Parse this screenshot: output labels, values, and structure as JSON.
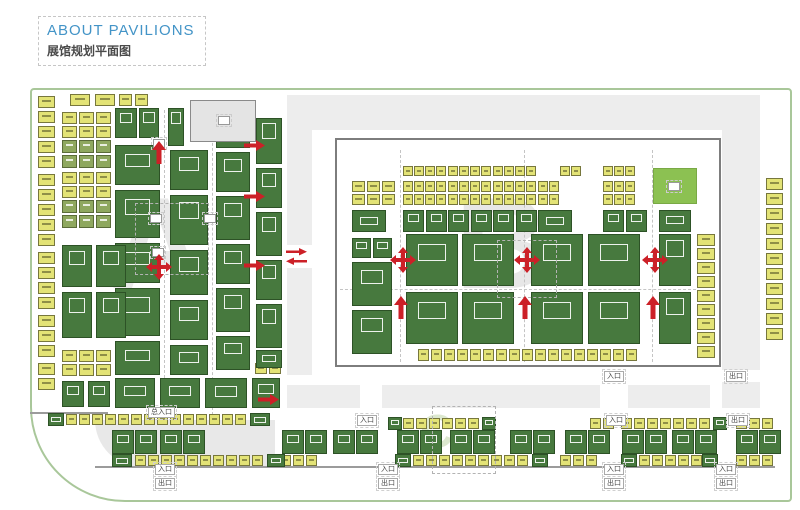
{
  "header": {
    "title_en": "ABOUT PAVILIONS",
    "title_zh": "展馆规划平面图"
  },
  "legend_colors": {
    "booth_yellow": "#e3e376",
    "booth_olive": "#8fa85f",
    "booth_green": "#47793e",
    "service_green": "#8cc152",
    "facility_gray": "#e4e4e4",
    "corridor_gray": "#ededed",
    "arrow_red": "#cc2027",
    "frame_green": "#a9c79a",
    "title_blue": "#4394c7"
  },
  "map": {
    "watermarks": [
      {
        "t": "A",
        "x": 110,
        "y": 178,
        "s": 130,
        "c": "#e9e9e9"
      },
      {
        "t": "B",
        "x": 455,
        "y": 178,
        "s": 130,
        "c": "#e7e7e7"
      },
      {
        "t": "C",
        "x": 420,
        "y": 408,
        "s": 46,
        "c": "#dce8cf"
      }
    ],
    "corridors": [
      [
        287,
        95,
        25,
        150
      ],
      [
        287,
        268,
        25,
        107
      ],
      [
        312,
        95,
        448,
        35
      ],
      [
        722,
        130,
        38,
        240
      ],
      [
        722,
        382,
        38,
        26
      ],
      [
        287,
        385,
        73,
        23
      ],
      [
        382,
        385,
        218,
        23
      ],
      [
        628,
        385,
        82,
        23
      ]
    ],
    "quarter": [
      95,
      420,
      180,
      47
    ],
    "wall": [
      335,
      138,
      386,
      229
    ],
    "roads": [
      [
        95,
        466,
        680
      ],
      [
        30,
        412,
        78
      ]
    ],
    "dashed_rects": [
      [
        135,
        203,
        72,
        70
      ],
      [
        497,
        240,
        58,
        56
      ],
      [
        432,
        406,
        62,
        66
      ]
    ],
    "vdash": [
      [
        164,
        110,
        418
      ],
      [
        212,
        108,
        415
      ],
      [
        400,
        150,
        362
      ],
      [
        524,
        150,
        362
      ],
      [
        652,
        150,
        362
      ]
    ],
    "hdash": [
      [
        340,
        289,
        356
      ]
    ],
    "markers": [
      [
        150,
        214
      ],
      [
        204,
        214
      ],
      [
        153,
        139
      ],
      [
        152,
        248
      ],
      [
        218,
        116
      ],
      [
        668,
        182
      ]
    ],
    "strips": [
      [
        38,
        96,
        5,
        0,
        15,
        17,
        12,
        "y"
      ],
      [
        38,
        174,
        5,
        0,
        15,
        17,
        12,
        "y"
      ],
      [
        38,
        252,
        4,
        0,
        15,
        17,
        12,
        "y"
      ],
      [
        38,
        315,
        3,
        0,
        15,
        17,
        12,
        "y"
      ],
      [
        38,
        363,
        2,
        0,
        15,
        17,
        12,
        "y"
      ],
      [
        70,
        94,
        2,
        25,
        0,
        20,
        12,
        "y"
      ],
      [
        119,
        94,
        2,
        16,
        0,
        13,
        12,
        "y"
      ],
      [
        62,
        112,
        3,
        17,
        0,
        15,
        12,
        "y"
      ],
      [
        62,
        126,
        3,
        17,
        0,
        15,
        12,
        "y"
      ],
      [
        62,
        140,
        3,
        17,
        0,
        15,
        13,
        "o"
      ],
      [
        62,
        155,
        3,
        17,
        0,
        15,
        13,
        "o"
      ],
      [
        62,
        172,
        3,
        17,
        0,
        15,
        12,
        "y"
      ],
      [
        62,
        186,
        3,
        17,
        0,
        15,
        12,
        "y"
      ],
      [
        62,
        200,
        3,
        17,
        0,
        15,
        13,
        "o"
      ],
      [
        62,
        215,
        3,
        17,
        0,
        15,
        13,
        "o"
      ],
      [
        62,
        350,
        3,
        17,
        0,
        15,
        12,
        "y"
      ],
      [
        62,
        364,
        3,
        17,
        0,
        15,
        12,
        "y"
      ],
      [
        255,
        363,
        2,
        14,
        0,
        12,
        11,
        "y"
      ],
      [
        403,
        166,
        4,
        11,
        0,
        10,
        10,
        "y"
      ],
      [
        448,
        166,
        4,
        11,
        0,
        10,
        10,
        "y"
      ],
      [
        493,
        166,
        4,
        11,
        0,
        10,
        10,
        "y"
      ],
      [
        560,
        166,
        2,
        11,
        0,
        10,
        10,
        "y"
      ],
      [
        603,
        166,
        3,
        11,
        0,
        10,
        10,
        "y"
      ],
      [
        352,
        181,
        3,
        15,
        0,
        13,
        11,
        "y"
      ],
      [
        403,
        181,
        4,
        11,
        0,
        10,
        11,
        "y"
      ],
      [
        448,
        181,
        4,
        11,
        0,
        10,
        11,
        "y"
      ],
      [
        493,
        181,
        4,
        11,
        0,
        10,
        11,
        "y"
      ],
      [
        538,
        181,
        2,
        11,
        0,
        10,
        11,
        "y"
      ],
      [
        603,
        181,
        3,
        11,
        0,
        10,
        11,
        "y"
      ],
      [
        352,
        194,
        3,
        15,
        0,
        13,
        11,
        "y"
      ],
      [
        403,
        194,
        4,
        11,
        0,
        10,
        11,
        "y"
      ],
      [
        448,
        194,
        4,
        11,
        0,
        10,
        11,
        "y"
      ],
      [
        493,
        194,
        4,
        11,
        0,
        10,
        11,
        "y"
      ],
      [
        538,
        194,
        2,
        11,
        0,
        10,
        11,
        "y"
      ],
      [
        603,
        194,
        3,
        11,
        0,
        10,
        11,
        "y"
      ],
      [
        418,
        349,
        17,
        13,
        0,
        11,
        12,
        "y"
      ],
      [
        697,
        234,
        9,
        0,
        14,
        18,
        12,
        "y"
      ],
      [
        766,
        178,
        11,
        0,
        15,
        17,
        12,
        "y"
      ],
      [
        66,
        414,
        14,
        13,
        0,
        11,
        11,
        "y"
      ],
      [
        403,
        418,
        6,
        13,
        0,
        11,
        11,
        "y"
      ],
      [
        590,
        418,
        2,
        13,
        0,
        11,
        11,
        "y"
      ],
      [
        621,
        418,
        7,
        13,
        0,
        11,
        11,
        "y"
      ],
      [
        736,
        418,
        3,
        13,
        0,
        11,
        11,
        "y"
      ],
      [
        135,
        455,
        10,
        13,
        0,
        11,
        11,
        "y"
      ],
      [
        280,
        455,
        3,
        13,
        0,
        11,
        11,
        "y"
      ],
      [
        413,
        455,
        9,
        13,
        0,
        11,
        11,
        "y"
      ],
      [
        560,
        455,
        3,
        13,
        0,
        11,
        11,
        "y"
      ],
      [
        639,
        455,
        5,
        13,
        0,
        11,
        11,
        "y"
      ],
      [
        736,
        455,
        3,
        13,
        0,
        11,
        11,
        "y"
      ],
      [
        112,
        430,
        2,
        23,
        0,
        22,
        24,
        "g"
      ],
      [
        160,
        430,
        2,
        23,
        0,
        22,
        24,
        "g"
      ],
      [
        282,
        430,
        2,
        23,
        0,
        22,
        24,
        "g"
      ],
      [
        333,
        430,
        2,
        23,
        0,
        22,
        24,
        "g"
      ],
      [
        397,
        430,
        2,
        23,
        0,
        22,
        24,
        "g"
      ],
      [
        450,
        430,
        2,
        23,
        0,
        22,
        24,
        "g"
      ],
      [
        510,
        430,
        2,
        23,
        0,
        22,
        24,
        "g"
      ],
      [
        565,
        430,
        2,
        23,
        0,
        22,
        24,
        "g"
      ],
      [
        622,
        430,
        2,
        23,
        0,
        22,
        24,
        "g"
      ],
      [
        672,
        430,
        2,
        23,
        0,
        22,
        24,
        "g"
      ],
      [
        736,
        430,
        2,
        23,
        0,
        22,
        24,
        "g"
      ]
    ],
    "blocks": [
      [
        115,
        108,
        22,
        30,
        "g"
      ],
      [
        139,
        108,
        20,
        30,
        "g"
      ],
      [
        168,
        108,
        16,
        38,
        "g"
      ],
      [
        115,
        145,
        45,
        40,
        "g"
      ],
      [
        115,
        190,
        45,
        48,
        "g"
      ],
      [
        115,
        243,
        45,
        40,
        "g"
      ],
      [
        115,
        288,
        45,
        48,
        "g"
      ],
      [
        115,
        341,
        45,
        34,
        "g"
      ],
      [
        170,
        150,
        38,
        40,
        "g"
      ],
      [
        170,
        195,
        38,
        50,
        "g"
      ],
      [
        170,
        250,
        38,
        45,
        "g"
      ],
      [
        170,
        300,
        38,
        40,
        "g"
      ],
      [
        170,
        345,
        38,
        30,
        "g"
      ],
      [
        216,
        112,
        34,
        36,
        "g"
      ],
      [
        216,
        152,
        34,
        40,
        "g"
      ],
      [
        216,
        196,
        34,
        44,
        "g"
      ],
      [
        216,
        244,
        34,
        40,
        "g"
      ],
      [
        216,
        288,
        34,
        44,
        "g"
      ],
      [
        216,
        336,
        34,
        34,
        "g"
      ],
      [
        256,
        118,
        26,
        46,
        "g"
      ],
      [
        256,
        168,
        26,
        40,
        "g"
      ],
      [
        256,
        212,
        26,
        44,
        "g"
      ],
      [
        256,
        260,
        26,
        40,
        "g"
      ],
      [
        256,
        304,
        26,
        44,
        "g"
      ],
      [
        256,
        350,
        26,
        18,
        "g"
      ],
      [
        62,
        245,
        30,
        42,
        "g"
      ],
      [
        96,
        245,
        30,
        42,
        "g"
      ],
      [
        62,
        292,
        30,
        46,
        "g"
      ],
      [
        96,
        292,
        30,
        46,
        "g"
      ],
      [
        62,
        381,
        22,
        26,
        "g"
      ],
      [
        88,
        381,
        22,
        26,
        "g"
      ],
      [
        115,
        378,
        40,
        30,
        "g"
      ],
      [
        160,
        378,
        40,
        30,
        "g"
      ],
      [
        205,
        378,
        42,
        30,
        "g"
      ],
      [
        252,
        378,
        28,
        30,
        "g"
      ],
      [
        352,
        238,
        19,
        20,
        "g"
      ],
      [
        373,
        238,
        19,
        20,
        "g"
      ],
      [
        352,
        262,
        40,
        44,
        "g"
      ],
      [
        352,
        310,
        40,
        44,
        "g"
      ],
      [
        406,
        234,
        52,
        52,
        "g"
      ],
      [
        462,
        234,
        52,
        52,
        "g"
      ],
      [
        406,
        292,
        52,
        52,
        "g"
      ],
      [
        462,
        292,
        52,
        52,
        "g"
      ],
      [
        531,
        234,
        52,
        52,
        "g"
      ],
      [
        588,
        234,
        52,
        52,
        "g"
      ],
      [
        531,
        292,
        52,
        52,
        "g"
      ],
      [
        588,
        292,
        52,
        52,
        "g"
      ],
      [
        659,
        234,
        32,
        52,
        "g"
      ],
      [
        659,
        292,
        32,
        52,
        "g"
      ],
      [
        659,
        210,
        32,
        22,
        "g"
      ],
      [
        352,
        210,
        34,
        22,
        "g"
      ],
      [
        403,
        210,
        21,
        22,
        "g"
      ],
      [
        426,
        210,
        21,
        22,
        "g"
      ],
      [
        448,
        210,
        21,
        22,
        "g"
      ],
      [
        471,
        210,
        21,
        22,
        "g"
      ],
      [
        493,
        210,
        21,
        22,
        "g"
      ],
      [
        516,
        210,
        21,
        22,
        "g"
      ],
      [
        538,
        210,
        34,
        22,
        "g"
      ],
      [
        603,
        210,
        21,
        22,
        "g"
      ],
      [
        626,
        210,
        21,
        22,
        "g"
      ],
      [
        653,
        168,
        44,
        36,
        "lg"
      ],
      [
        190,
        100,
        66,
        42,
        "gray"
      ],
      [
        48,
        413,
        16,
        13,
        "g"
      ],
      [
        250,
        413,
        20,
        13,
        "g"
      ],
      [
        388,
        417,
        14,
        13,
        "g"
      ],
      [
        482,
        417,
        14,
        13,
        "g"
      ],
      [
        713,
        417,
        14,
        13,
        "g"
      ],
      [
        112,
        454,
        20,
        13,
        "g"
      ],
      [
        267,
        454,
        18,
        13,
        "g"
      ],
      [
        395,
        454,
        16,
        13,
        "g"
      ],
      [
        532,
        454,
        16,
        13,
        "g"
      ],
      [
        621,
        454,
        16,
        13,
        "g"
      ],
      [
        702,
        454,
        16,
        13,
        "g"
      ]
    ],
    "arrows": [
      [
        152,
        141,
        "up"
      ],
      [
        146,
        254,
        "cross"
      ],
      [
        244,
        138,
        "right"
      ],
      [
        244,
        189,
        "right"
      ],
      [
        244,
        258,
        "right"
      ],
      [
        258,
        392,
        "right"
      ],
      [
        286,
        248,
        "pair"
      ],
      [
        390,
        247,
        "cross"
      ],
      [
        514,
        247,
        "cross"
      ],
      [
        642,
        247,
        "cross"
      ],
      [
        394,
        296,
        "up"
      ],
      [
        518,
        296,
        "up"
      ],
      [
        646,
        296,
        "up"
      ]
    ],
    "labels": [
      [
        604,
        371,
        "entrance",
        "入口"
      ],
      [
        726,
        371,
        "exit",
        "出口"
      ],
      [
        357,
        415,
        "entrance",
        "入口"
      ],
      [
        606,
        415,
        "entrance",
        "入口"
      ],
      [
        728,
        415,
        "exit",
        "出口"
      ],
      [
        148,
        407,
        "main-entrance",
        "总入口"
      ]
    ],
    "stacked_labels": [
      [
        155,
        464,
        "入口",
        "出口"
      ],
      [
        378,
        464,
        "入口",
        "出口"
      ],
      [
        604,
        464,
        "入口",
        "出口"
      ],
      [
        716,
        464,
        "入口",
        "出口"
      ]
    ],
    "arrow_color": "#cc2027"
  }
}
